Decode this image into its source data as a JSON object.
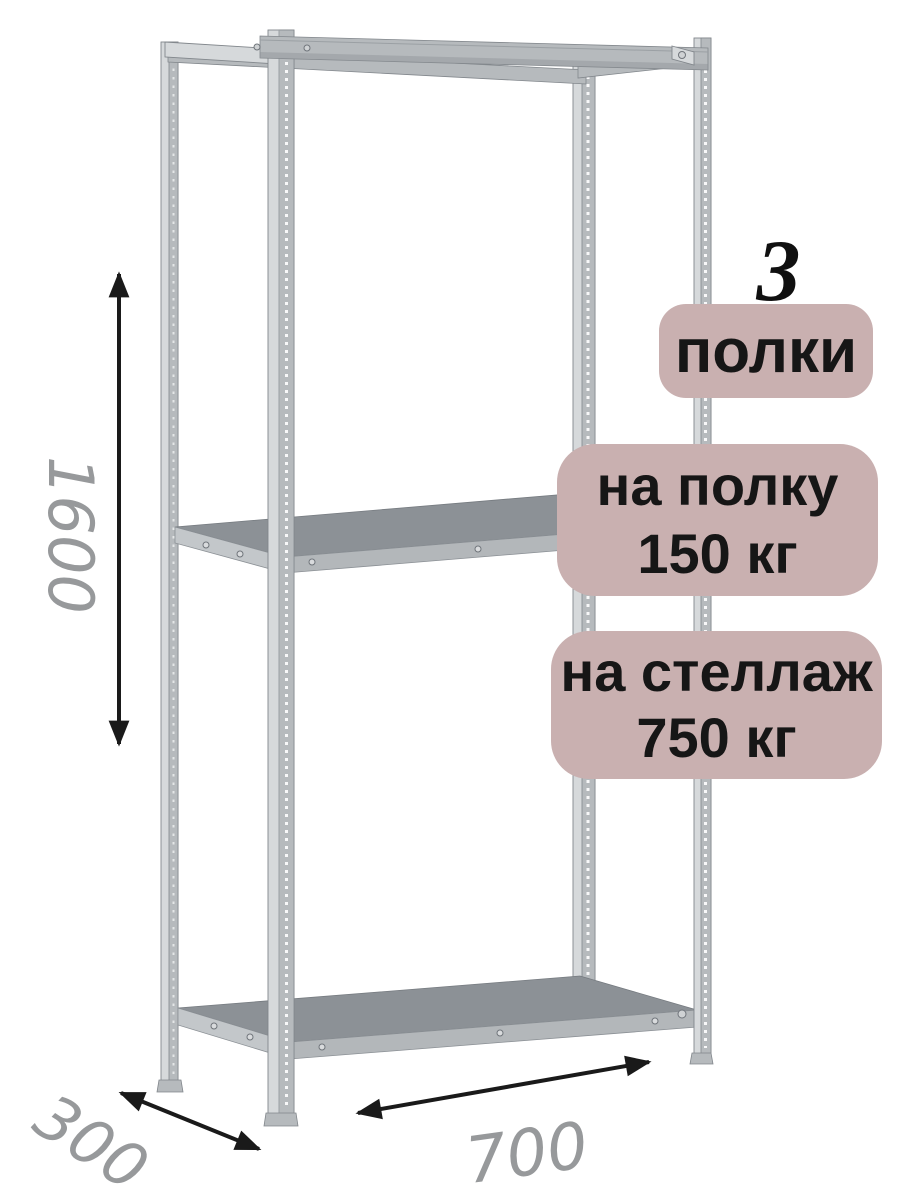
{
  "illustration": {
    "name": "metal-shelving-rack",
    "shelves_shown": 3,
    "parts": [
      "posts-perforated",
      "top-frame-beams",
      "middle-shelf",
      "bottom-shelf"
    ]
  },
  "badges": {
    "count": "3",
    "count_label": "полки",
    "shelf_load": {
      "line1": "на полку",
      "line2": "150 кг"
    },
    "rack_load": {
      "line1": "на стеллаж",
      "line2": "750 кг"
    }
  },
  "dimensions": {
    "height": "1600",
    "depth": "300",
    "width": "700"
  },
  "colors": {
    "badge_bg": "#c9b0b0",
    "badge_text": "#161616",
    "dim_text": "#97999b",
    "arrow": "#1a1a1a",
    "metal_light": "#d6d9db",
    "metal_mid": "#b6babd",
    "metal_dark": "#8d9297",
    "metal_edge": "#82878c",
    "shelf_top": "#8c9196",
    "shelf_face": "#b3b7ba",
    "bg": "#ffffff"
  }
}
